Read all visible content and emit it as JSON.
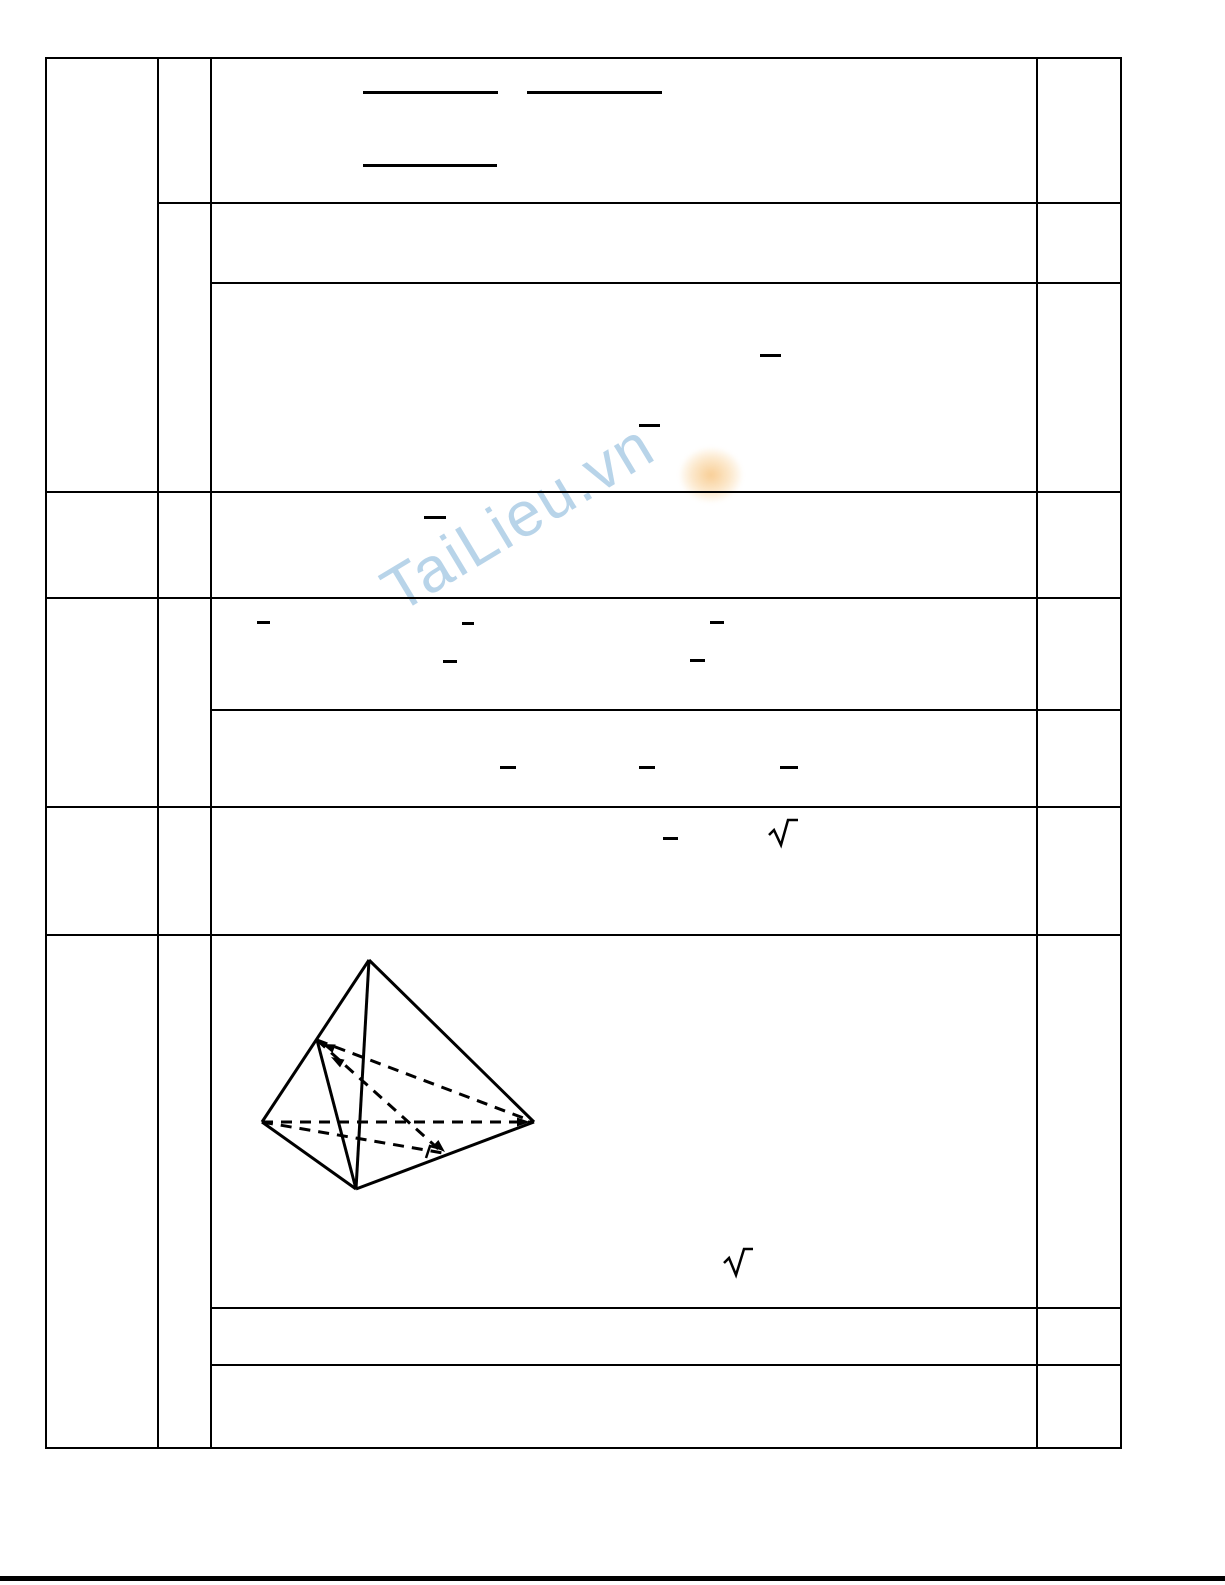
{
  "page": {
    "width": 1225,
    "height": 1585,
    "background": "#ffffff",
    "line_color": "#000000"
  },
  "watermark": {
    "text": "TaiLieu.vn",
    "text_color": "#a6c9e3",
    "blob_color": "#f7c582",
    "rotation_deg": -31
  },
  "table": {
    "description": "grading-rubric table, all cells blank except math fragments and figure",
    "v_lines": [
      {
        "x": 45,
        "y1": 57,
        "y2": 1447
      },
      {
        "x": 157,
        "y1": 57,
        "y2": 1447
      },
      {
        "x": 210,
        "y1": 57,
        "y2": 1447
      },
      {
        "x": 1036,
        "y1": 57,
        "y2": 1447
      },
      {
        "x": 1120,
        "y1": 57,
        "y2": 1447
      }
    ],
    "h_lines": [
      {
        "y": 57,
        "x1": 45,
        "x2": 1120
      },
      {
        "y": 202,
        "x1": 157,
        "x2": 1120
      },
      {
        "y": 282,
        "x1": 210,
        "x2": 1120
      },
      {
        "y": 491,
        "x1": 45,
        "x2": 1120
      },
      {
        "y": 597,
        "x1": 45,
        "x2": 1120
      },
      {
        "y": 709,
        "x1": 210,
        "x2": 1120
      },
      {
        "y": 806,
        "x1": 45,
        "x2": 1120
      },
      {
        "y": 934,
        "x1": 45,
        "x2": 1120
      },
      {
        "y": 1307,
        "x1": 210,
        "x2": 1120
      },
      {
        "y": 1364,
        "x1": 210,
        "x2": 1120
      },
      {
        "y": 1447,
        "x1": 45,
        "x2": 1120
      }
    ],
    "columns": [
      {
        "name": "question-number-column",
        "x": 45,
        "w": 112
      },
      {
        "name": "part-label-column",
        "x": 157,
        "w": 53
      },
      {
        "name": "solution-content-column",
        "x": 210,
        "w": 826
      },
      {
        "name": "points-column",
        "x": 1036,
        "w": 84
      }
    ]
  },
  "math_marks": {
    "fraction_bars": [
      {
        "x": 363,
        "y": 91,
        "w": 135
      },
      {
        "x": 527,
        "y": 91,
        "w": 135
      },
      {
        "x": 363,
        "y": 164,
        "w": 134
      }
    ],
    "dashes": [
      {
        "x": 760,
        "y": 354,
        "w": 21
      },
      {
        "x": 639,
        "y": 424,
        "w": 21
      },
      {
        "x": 424,
        "y": 516,
        "w": 22
      },
      {
        "x": 257,
        "y": 621,
        "w": 13
      },
      {
        "x": 462,
        "y": 622,
        "w": 12
      },
      {
        "x": 710,
        "y": 621,
        "w": 14
      },
      {
        "x": 443,
        "y": 660,
        "w": 14
      },
      {
        "x": 690,
        "y": 659,
        "w": 15
      },
      {
        "x": 500,
        "y": 766,
        "w": 16
      },
      {
        "x": 639,
        "y": 766,
        "w": 16
      },
      {
        "x": 780,
        "y": 766,
        "w": 18
      },
      {
        "x": 663,
        "y": 837,
        "w": 15
      }
    ],
    "radicals": [
      {
        "points": "769,835 774,830 781,845 788,820 798,820"
      },
      {
        "points": "724,1263 729,1258 736,1275 744,1249 753,1249"
      }
    ]
  },
  "figure": {
    "type": "tetrahedron-diagram",
    "solid_segments": [
      [
        369,
        960,
        262,
        1122
      ],
      [
        369,
        960,
        534,
        1122
      ],
      [
        262,
        1122,
        356,
        1189
      ],
      [
        534,
        1122,
        356,
        1189
      ],
      [
        369,
        960,
        356,
        1189
      ],
      [
        317,
        1040,
        356,
        1189
      ]
    ],
    "dashed_segments": [
      [
        262,
        1122,
        534,
        1122
      ],
      [
        317,
        1040,
        534,
        1122
      ],
      [
        317,
        1040,
        443,
        1153
      ],
      [
        262,
        1122,
        443,
        1153
      ]
    ],
    "arrowheads": [
      {
        "x": 322,
        "y": 1044,
        "angle": 201
      },
      {
        "x": 331,
        "y": 1057,
        "angle": 210
      },
      {
        "x": 530,
        "y": 1122,
        "angle": 0
      },
      {
        "x": 445,
        "y": 1152,
        "angle": 42
      }
    ],
    "right_angle_mark": "426,1158 430,1146 442,1149"
  },
  "footer_rule": {
    "y": 1576,
    "x1": 0,
    "x2": 1225,
    "thickness": 5
  }
}
